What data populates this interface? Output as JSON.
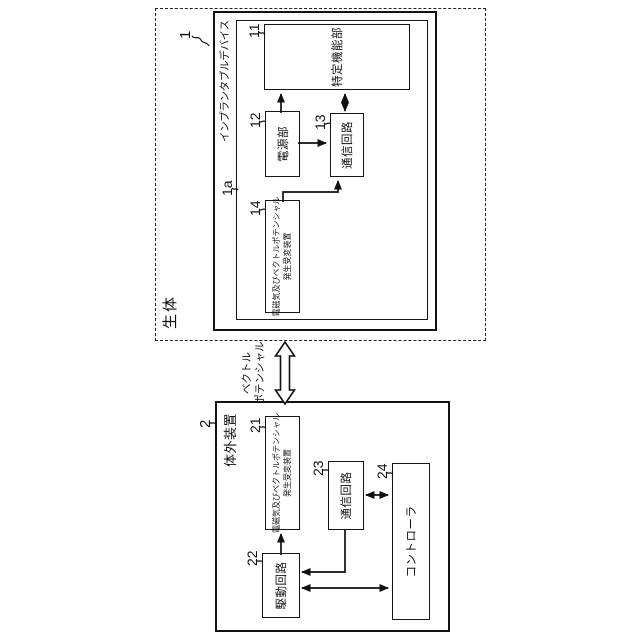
{
  "figure": {
    "living_body_label": "生体",
    "vector_potential_label": {
      "line1": "ベクトル",
      "line2": "ポテンシャル"
    },
    "implant_device": {
      "ref": "1",
      "title": "インプランタブルデバイス",
      "inner_ref": "1a",
      "blocks": {
        "specific_function": {
          "ref": "11",
          "label": "特定機能部"
        },
        "power_supply": {
          "ref": "12",
          "label": "電源部"
        },
        "comm_circuit": {
          "ref": "13",
          "label": "通信回路"
        },
        "em_vp_transducer": {
          "ref": "14",
          "label_line1": "電磁気及びベクトルポテンシャル",
          "label_line2": "発生受変装置"
        }
      }
    },
    "external_device": {
      "ref": "2",
      "title": "体外装置",
      "blocks": {
        "em_vp_transducer": {
          "ref": "21",
          "label_line1": "電磁気及びベクトルポテンシャル",
          "label_line2": "発生受変装置"
        },
        "drive_circuit": {
          "ref": "22",
          "label": "駆動回路"
        },
        "comm_circuit": {
          "ref": "23",
          "label": "通信回路"
        },
        "controller": {
          "ref": "24",
          "label": "コントローラ"
        }
      }
    },
    "colors": {
      "line": "#111111",
      "background": "#ffffff"
    }
  }
}
